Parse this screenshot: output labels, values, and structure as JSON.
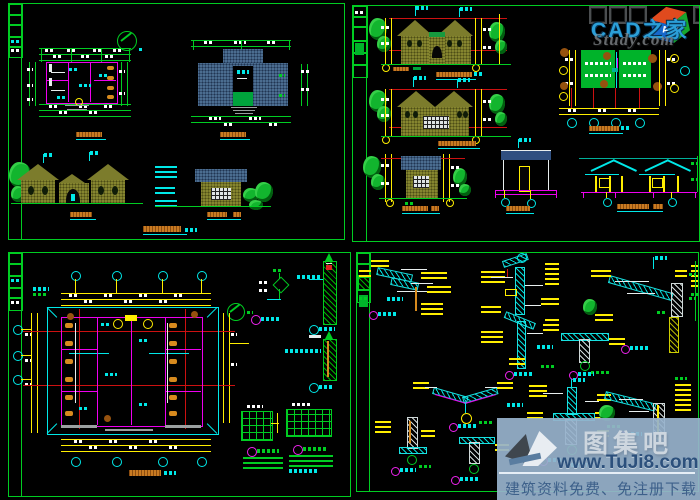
{
  "meta": {
    "description": "Black-background CAD drawing collage of four architectural sheets: plans, roof plan, elevations, sections and construction details",
    "background": "#000000"
  },
  "palette": {
    "sheet_border_green": "#00cc22",
    "dimension_yellow": "#ffee00",
    "annotation_cyan": "#00e8e8",
    "wall_magenta": "#ee00ee",
    "axis_red": "#cc1111",
    "wall_olive": "#85852f",
    "roof_slate_blue": "#4b6d90",
    "fill_green": "#00a33c",
    "title_hatch_orange": "#c87a22",
    "tree_green": "#12b52e"
  },
  "sheets": [
    {
      "id": "sheet-1",
      "position": "top-left",
      "content": "floor plan, roof plan, two elevations"
    },
    {
      "id": "sheet-2",
      "position": "top-right",
      "content": "two front elevations, roof plan, side elevation, two sections"
    },
    {
      "id": "sheet-3",
      "position": "bottom-left",
      "content": "large floor plan with axis grid and wall/window details"
    },
    {
      "id": "sheet-4",
      "position": "bottom-right",
      "content": "construction detail drawings"
    }
  ],
  "watermarks": {
    "cad_home": {
      "brand": "CAD之家",
      "brand_color": "#2b9fd8",
      "ghost_text": "Study.com",
      "cube": {
        "letter_a": "A",
        "letter_d": "D",
        "face_top": "#e04a1e",
        "face_a": "#1668cc",
        "face_d": "#17a62e"
      }
    },
    "tuji8": {
      "site_name": "图集吧",
      "url": "www.TuJi8.com",
      "tagline": "建筑资料免费、免注册下载",
      "box_color": "#97b1cb",
      "url_color": "#2c507c",
      "tagline_color": "#3d608a"
    }
  }
}
